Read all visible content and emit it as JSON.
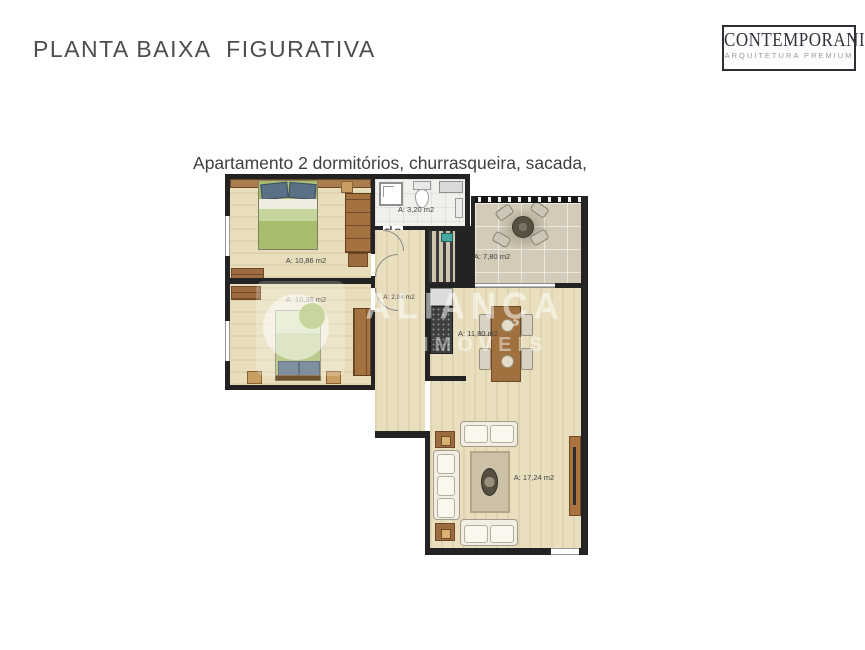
{
  "page": {
    "title": "PLANTA BAIXA  FIGURATIVA",
    "subtitle_line1": "Apartamento 2 dormitórios, churrasqueira, sacada,",
    "subtitle_line2": "77,00 m2 de  área útil"
  },
  "logo": {
    "name": "CONTEMPORANI",
    "tagline": "ARQUITETURA PREMIUM"
  },
  "watermark": {
    "line1": "ALIANÇA",
    "line2": "IMÓVEIS"
  },
  "floorplan": {
    "rooms": [
      {
        "id": "bedroom-1",
        "area_label": "A: 10,86 m2"
      },
      {
        "id": "bedroom-2",
        "area_label": "A: 10,36 m2"
      },
      {
        "id": "bathroom",
        "area_label": "A: 3,20 m2"
      },
      {
        "id": "balcony",
        "area_label": "A: 7,80 m2"
      },
      {
        "id": "hall",
        "area_label": "A: 2,04 m2"
      },
      {
        "id": "kitchen",
        "area_label": "A: 11,80 m2"
      },
      {
        "id": "living",
        "area_label": "A: 17,24 m2"
      }
    ],
    "colors": {
      "wall": "#232323",
      "wood_floor": "#e9dfbf",
      "balcony_tile": "#d3cab7",
      "bed_green": "#a9bd6e",
      "pillow_blue": "#5a7085",
      "furniture_wood": "#9c6b3f",
      "counter_dark": "#3f3f3f",
      "sink_teal": "#45a8a2",
      "title_gray": "#4d4d4d"
    }
  }
}
